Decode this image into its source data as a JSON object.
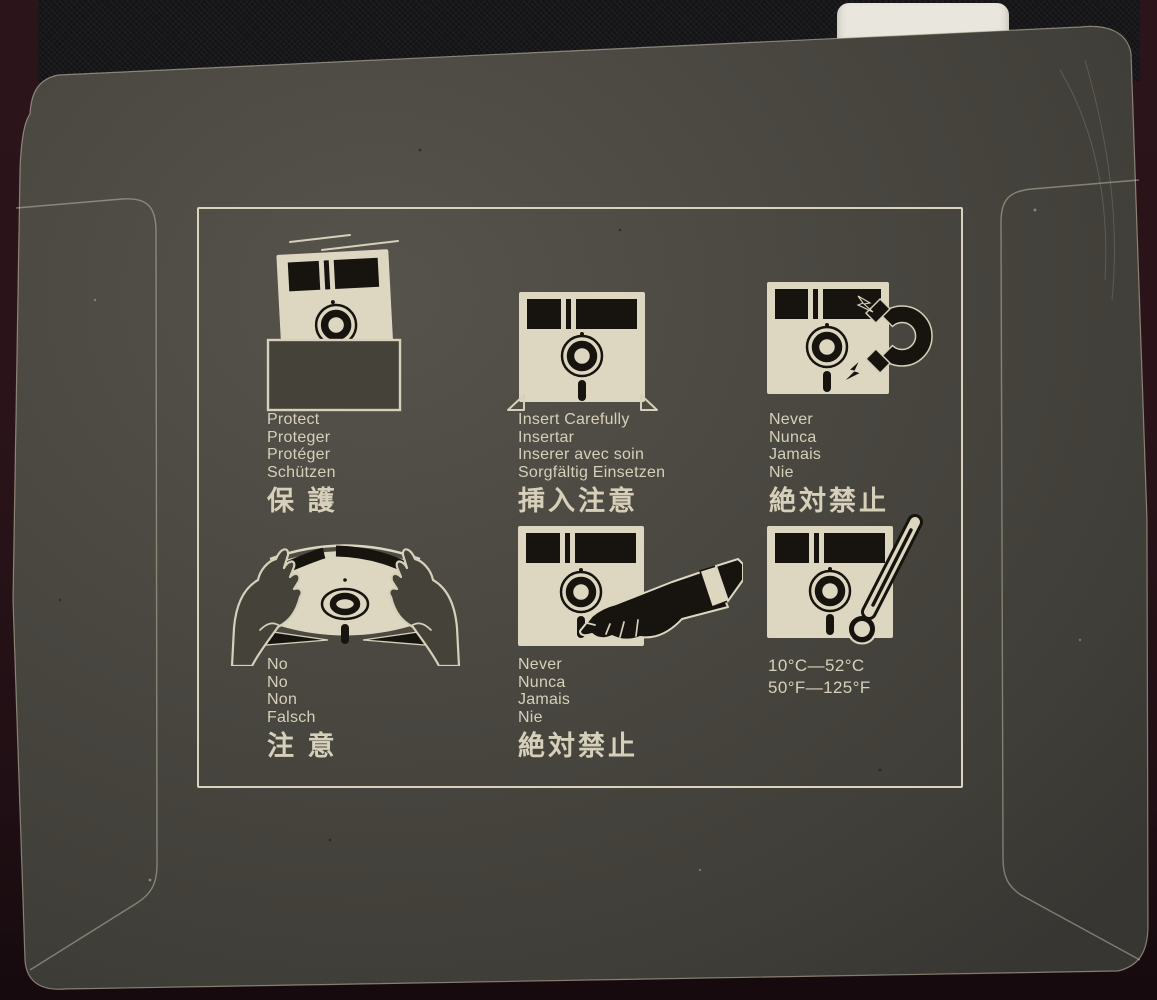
{
  "colors": {
    "background_maroon": "#2a141a",
    "cardboard": "#474440",
    "print_cream": "#d9d3bd",
    "print_ink": "#17130e",
    "fabric_black": "#141417",
    "tab_white": "#e9e6dd"
  },
  "instructions": {
    "panels": [
      {
        "id": "protect",
        "icon": "disk-in-sleeve-icon",
        "latin": [
          "Protect",
          "Proteger",
          "Protéger",
          "Schützen"
        ],
        "cjk": "保 護"
      },
      {
        "id": "insert-carefully",
        "icon": "disk-into-drive-icon",
        "latin": [
          "Insert Carefully",
          "Insertar",
          "Inserer avec soin",
          "Sorgfältig Einsetzen"
        ],
        "cjk": "挿入注意"
      },
      {
        "id": "never-magnet",
        "icon": "magnet-warning-icon",
        "latin": [
          "Never",
          "Nunca",
          "Jamais",
          "Nie"
        ],
        "cjk": "絶対禁止"
      },
      {
        "id": "no-bend",
        "icon": "bending-hands-icon",
        "latin": [
          "No",
          "No",
          "Non",
          "Falsch"
        ],
        "cjk": "注 意"
      },
      {
        "id": "never-touch",
        "icon": "touching-hand-icon",
        "latin": [
          "Never",
          "Nunca",
          "Jamais",
          "Nie"
        ],
        "cjk": "絶対禁止"
      },
      {
        "id": "temperature",
        "icon": "thermometer-icon",
        "latin": [
          "10°C—52°C",
          "50°F—125°F"
        ],
        "cjk": ""
      }
    ]
  }
}
